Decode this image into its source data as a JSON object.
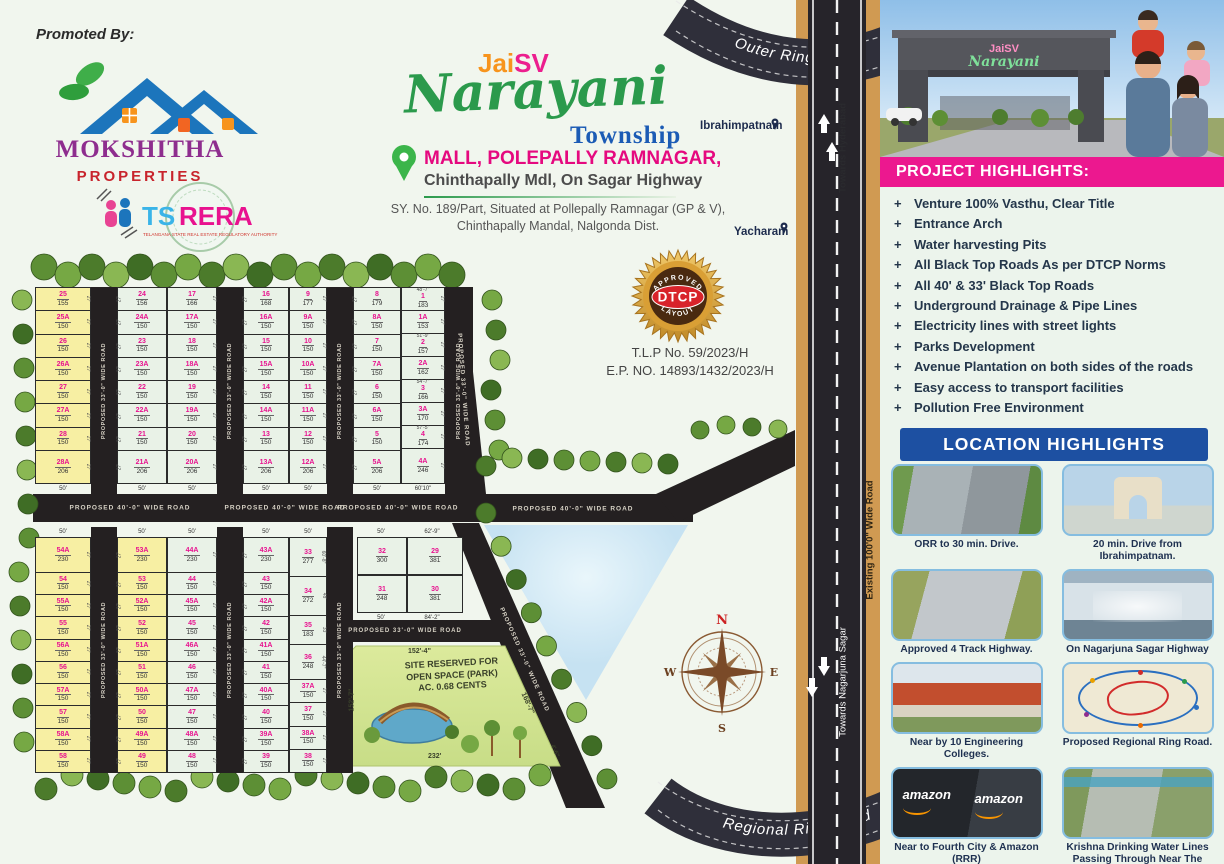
{
  "colors": {
    "pink_accent": "#e8128f",
    "magenta_banner": "#ec188f",
    "blue_banner": "#1d50a2",
    "brand_purple": "#8e2d8e",
    "brand_red": "#c8242c",
    "brand_green": "#2b9a4c",
    "township_blue": "#1b5bb5",
    "road_black": "#242021",
    "highway_tan": "#d09a52",
    "plot_yellow": "#f7efa3",
    "plot_green": "#e9f2e7",
    "badge_gold": "#d99f35",
    "badge_red": "#d8232a"
  },
  "promoter": {
    "heading": "Promoted By:",
    "name": "MOKSHITHA",
    "subtitle": "PROPERTIES",
    "rera_ts": "TS",
    "rera_rera": "RERA",
    "rera_tagline": "TELANGANA STATE REAL ESTATE REGULATORY AUTHORITY"
  },
  "title": {
    "jai": "Jai",
    "sv": "SV",
    "name": "Narayani",
    "township": "Township",
    "location_line1": "MALL, POLEPALLY RAMNAGAR,",
    "location_line2": "Chinthapally Mdl, On Sagar Highway",
    "survey_line1": "SY. No. 189/Part, Situated at Pollepally Ramnagar (GP & V),",
    "survey_line2": "Chinthapally Mandal, Nalgonda Dist."
  },
  "approval": {
    "badge_top": "APPROVED",
    "badge_center": "DTCP",
    "badge_bottom": "LAYOUT",
    "tlp_no": "T.L.P No. 59/2023/H",
    "ep_no": "E.P. NO. 14893/1432/2023/H"
  },
  "places": {
    "north_town": "Ibrahimpatnam",
    "south_town": "Yacharam"
  },
  "highway": {
    "outer_ring_road": "Outer Ring Road",
    "regional_ring_road": "Regional Ring Road",
    "towards_north": "Towards Hyderabad",
    "towards_south": "Towards Nagarjuna Sagar",
    "existing_road": "Existing 100'0\" Wide Road"
  },
  "map": {
    "road40_label": "PROPOSED 40'-0\" WIDE ROAD",
    "road33_label": "PROPOSED 33'-0\" WIDE ROAD",
    "default_side_dim": "27'",
    "compass": {
      "n": "N",
      "e": "E",
      "s": "S",
      "w": "W"
    },
    "park": {
      "line1": "SITE RESERVED FOR",
      "line2": "OPEN SPACE (PARK)",
      "line3": "AC. 0.68 CENTS",
      "dim_top": "152'-4\"",
      "dim_left": "152'-7\"",
      "dim_right": "168'-7\"",
      "dim_bottom": "232'",
      "dim_corner": "4'-6\""
    },
    "top_block": {
      "columns": [
        {
          "color": "yellow",
          "bottom": "50'",
          "plots": [
            {
              "n": "25",
              "a": "155"
            },
            {
              "n": "25A",
              "a": "150"
            },
            {
              "n": "26",
              "a": "150"
            },
            {
              "n": "26A",
              "a": "150"
            },
            {
              "n": "27",
              "a": "150"
            },
            {
              "n": "27A",
              "a": "150"
            },
            {
              "n": "28",
              "a": "150"
            },
            {
              "n": "28A",
              "a": "206",
              "h": 32
            }
          ]
        },
        {
          "color": "green",
          "bottom": "50'",
          "plots": [
            {
              "n": "24",
              "a": "156"
            },
            {
              "n": "24A",
              "a": "150"
            },
            {
              "n": "23",
              "a": "150"
            },
            {
              "n": "23A",
              "a": "150"
            },
            {
              "n": "22",
              "a": "150"
            },
            {
              "n": "22A",
              "a": "150"
            },
            {
              "n": "21",
              "a": "150"
            },
            {
              "n": "21A",
              "a": "206",
              "h": 32
            }
          ]
        },
        {
          "color": "green",
          "bottom": "50'",
          "plots": [
            {
              "n": "17",
              "a": "166"
            },
            {
              "n": "17A",
              "a": "150"
            },
            {
              "n": "18",
              "a": "150"
            },
            {
              "n": "18A",
              "a": "150"
            },
            {
              "n": "19",
              "a": "150"
            },
            {
              "n": "19A",
              "a": "150"
            },
            {
              "n": "20",
              "a": "150"
            },
            {
              "n": "20A",
              "a": "206",
              "h": 32
            }
          ]
        },
        {
          "color": "green",
          "bottom": "50'",
          "plots": [
            {
              "n": "16",
              "a": "168"
            },
            {
              "n": "16A",
              "a": "150"
            },
            {
              "n": "15",
              "a": "150"
            },
            {
              "n": "15A",
              "a": "150"
            },
            {
              "n": "14",
              "a": "150"
            },
            {
              "n": "14A",
              "a": "150"
            },
            {
              "n": "13",
              "a": "150"
            },
            {
              "n": "13A",
              "a": "206",
              "h": 32
            }
          ]
        },
        {
          "color": "green",
          "bottom": "50'",
          "plots": [
            {
              "n": "9",
              "a": "177"
            },
            {
              "n": "9A",
              "a": "150"
            },
            {
              "n": "10",
              "a": "150"
            },
            {
              "n": "10A",
              "a": "150"
            },
            {
              "n": "11",
              "a": "150"
            },
            {
              "n": "11A",
              "a": "150"
            },
            {
              "n": "12",
              "a": "150"
            },
            {
              "n": "12A",
              "a": "206",
              "h": 32
            }
          ]
        },
        {
          "color": "green",
          "bottom": "50'",
          "plots": [
            {
              "n": "8",
              "a": "179"
            },
            {
              "n": "8A",
              "a": "150"
            },
            {
              "n": "7",
              "a": "150"
            },
            {
              "n": "7A",
              "a": "150"
            },
            {
              "n": "6",
              "a": "150"
            },
            {
              "n": "6A",
              "a": "150"
            },
            {
              "n": "5",
              "a": "150"
            },
            {
              "n": "5A",
              "a": "206",
              "h": 32
            }
          ]
        },
        {
          "color": "green",
          "bottom": "60'10\"",
          "plots": [
            {
              "n": "1",
              "a": "183",
              "dim": "48'-7\""
            },
            {
              "n": "1A",
              "a": "153"
            },
            {
              "n": "2",
              "a": "157",
              "dim": "51'-9\""
            },
            {
              "n": "2A",
              "a": "162"
            },
            {
              "n": "3",
              "a": "166",
              "dim": "54'-7\""
            },
            {
              "n": "3A",
              "a": "170"
            },
            {
              "n": "4",
              "a": "174",
              "dim": "57'-5\""
            },
            {
              "n": "4A",
              "a": "246",
              "h": 34
            }
          ]
        }
      ]
    },
    "bottom_block": {
      "columns": [
        {
          "color": "yellow",
          "top": "50'",
          "plots": [
            {
              "n": "54A",
              "a": "230",
              "h": 34
            },
            {
              "n": "54",
              "a": "150"
            },
            {
              "n": "55A",
              "a": "150"
            },
            {
              "n": "55",
              "a": "150"
            },
            {
              "n": "56A",
              "a": "150"
            },
            {
              "n": "56",
              "a": "150"
            },
            {
              "n": "57A",
              "a": "150"
            },
            {
              "n": "57",
              "a": "150"
            },
            {
              "n": "58A",
              "a": "150"
            },
            {
              "n": "58",
              "a": "150"
            }
          ]
        },
        {
          "color": "yellow",
          "top": "50'",
          "plots": [
            {
              "n": "53A",
              "a": "230",
              "h": 34
            },
            {
              "n": "53",
              "a": "150"
            },
            {
              "n": "52A",
              "a": "150"
            },
            {
              "n": "52",
              "a": "150"
            },
            {
              "n": "51A",
              "a": "150"
            },
            {
              "n": "51",
              "a": "150"
            },
            {
              "n": "50A",
              "a": "150"
            },
            {
              "n": "50",
              "a": "150"
            },
            {
              "n": "49A",
              "a": "150"
            },
            {
              "n": "49",
              "a": "150"
            }
          ]
        },
        {
          "color": "green",
          "top": "50'",
          "plots": [
            {
              "n": "44A",
              "a": "230",
              "h": 34
            },
            {
              "n": "44",
              "a": "150"
            },
            {
              "n": "45A",
              "a": "150"
            },
            {
              "n": "45",
              "a": "150"
            },
            {
              "n": "46A",
              "a": "150"
            },
            {
              "n": "46",
              "a": "150"
            },
            {
              "n": "47A",
              "a": "150"
            },
            {
              "n": "47",
              "a": "150"
            },
            {
              "n": "48A",
              "a": "150"
            },
            {
              "n": "48",
              "a": "150"
            }
          ]
        },
        {
          "color": "green",
          "top": "50'",
          "plots": [
            {
              "n": "43A",
              "a": "230",
              "h": 34
            },
            {
              "n": "43",
              "a": "150"
            },
            {
              "n": "42A",
              "a": "150"
            },
            {
              "n": "42",
              "a": "150"
            },
            {
              "n": "41A",
              "a": "150"
            },
            {
              "n": "41",
              "a": "150"
            },
            {
              "n": "40A",
              "a": "150"
            },
            {
              "n": "40",
              "a": "150"
            },
            {
              "n": "39A",
              "a": "150"
            },
            {
              "n": "39",
              "a": "150"
            }
          ]
        },
        {
          "color": "green",
          "top": "50'",
          "plots": [
            {
              "n": "33",
              "a": "277",
              "h": 38,
              "sdim": "60'-8\""
            },
            {
              "n": "34",
              "a": "272",
              "h": 38,
              "sdim": "48'"
            },
            {
              "n": "35",
              "a": "183",
              "h": 28,
              "sdim": "33'"
            },
            {
              "n": "36",
              "a": "248",
              "h": 34,
              "sdim": "44'-7\""
            },
            {
              "n": "37A",
              "a": "150"
            },
            {
              "n": "37",
              "a": "150"
            },
            {
              "n": "38A",
              "a": "150"
            },
            {
              "n": "38",
              "a": "150"
            }
          ]
        }
      ]
    },
    "corner_block": {
      "rows": [
        [
          {
            "n": "32",
            "a": "300",
            "edge": "50'"
          },
          {
            "n": "29",
            "a": "381",
            "edge": "62'-9\""
          }
        ],
        [
          {
            "n": "31",
            "a": "248",
            "edge": "50'"
          },
          {
            "n": "30",
            "a": "381",
            "edge": "84'-2\""
          }
        ]
      ]
    }
  },
  "panel": {
    "entrance_sign_line1": "JaiSV",
    "entrance_sign_line2": "Narayani",
    "project_highlights": {
      "title": "PROJECT HIGHLIGHTS:",
      "items": [
        "Venture 100% Vasthu, Clear Title",
        "Entrance Arch",
        "Water harvesting Pits",
        "All Black Top Roads As per DTCP Norms",
        "All 40' & 33' Black Top Roads",
        "Underground Drainage & Pipe Lines",
        "Electricity lines with street lights",
        "Parks Development",
        "Avenue Plantation on both sides of the roads",
        "Easy access to transport facilities",
        "Pollution Free Environment"
      ]
    },
    "location_highlights": {
      "title": "LOCATION HIGHLIGHTS",
      "amazon_text": "amazon",
      "cards": [
        {
          "caption": "ORR to 30 min. Drive."
        },
        {
          "caption": "20 min. Drive from Ibrahimpatnam."
        },
        {
          "caption": "Approved 4 Track Highway."
        },
        {
          "caption": "On Nagarjuna Sagar Highway"
        },
        {
          "caption": "Near by 10 Engineering Colleges."
        },
        {
          "caption": "Proposed Regional Ring Road."
        },
        {
          "caption": "Near to Fourth City & Amazon (RRR)"
        },
        {
          "caption": "Krishna Drinking Water Lines Passing Through Near The Project"
        }
      ]
    }
  }
}
